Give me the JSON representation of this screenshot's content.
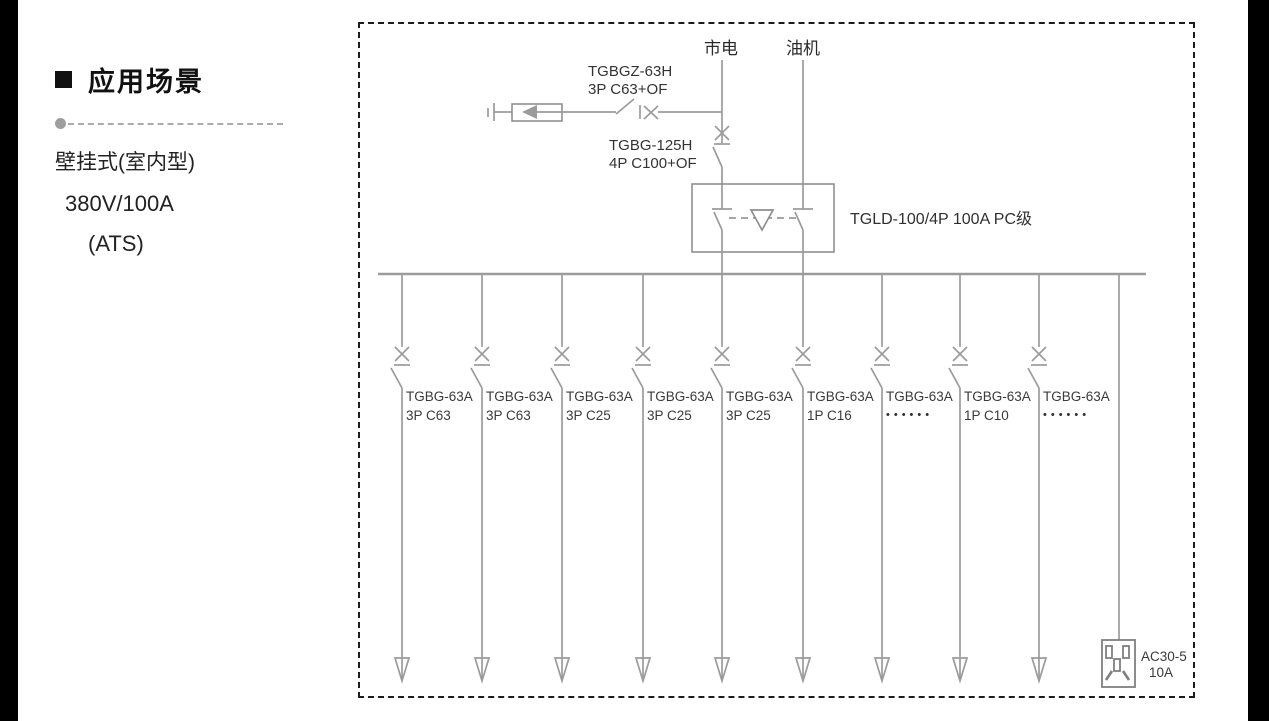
{
  "left_panel": {
    "title": "应用场景",
    "lines": [
      "壁挂式(室内型)",
      "380V/100A",
      "(ATS)"
    ]
  },
  "diagram": {
    "sources": {
      "mains": "市电",
      "generator": "油机"
    },
    "spd_breaker": {
      "model": "TGBGZ-63H",
      "spec": "3P C63+OF"
    },
    "main_breaker": {
      "model": "TGBG-125H",
      "spec": "4P C100+OF"
    },
    "ats": {
      "label": "TGLD-100/4P 100A PC级"
    },
    "branches": [
      {
        "model": "TGBG-63A",
        "spec": "3P C63"
      },
      {
        "model": "TGBG-63A",
        "spec": "3P C63"
      },
      {
        "model": "TGBG-63A",
        "spec": "3P C25"
      },
      {
        "model": "TGBG-63A",
        "spec": "3P C25"
      },
      {
        "model": "TGBG-63A",
        "spec": "3P C25"
      },
      {
        "model": "TGBG-63A",
        "spec": "1P C16"
      },
      {
        "model": "TGBG-63A",
        "spec": "••••••"
      },
      {
        "model": "TGBG-63A",
        "spec": "1P C10"
      },
      {
        "model": "TGBG-63A",
        "spec": "••••••"
      }
    ],
    "socket": {
      "model": "AC30-5",
      "rating": "10A"
    }
  },
  "colors": {
    "wire": "#9b9b9b",
    "border": "#1c1c1c",
    "text": "#3a3a3a"
  }
}
